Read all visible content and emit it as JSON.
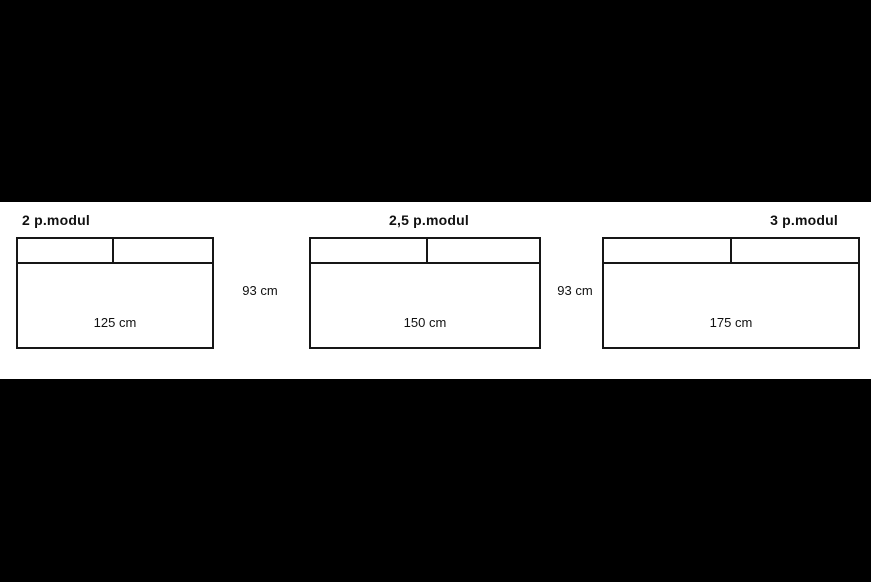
{
  "diagram": {
    "description": "Sofa module size diagram",
    "colors": {
      "background": "#000000",
      "panel": "#ffffff",
      "line": "#161616",
      "text": "#111111"
    },
    "modules": [
      {
        "title": "2 p.modul",
        "width_label": "125 cm"
      },
      {
        "title": "2,5 p.modul",
        "width_label": "150 cm"
      },
      {
        "title": "3 p.modul",
        "width_label": "175 cm"
      }
    ],
    "depth_labels": [
      "93 cm",
      "93 cm"
    ]
  }
}
